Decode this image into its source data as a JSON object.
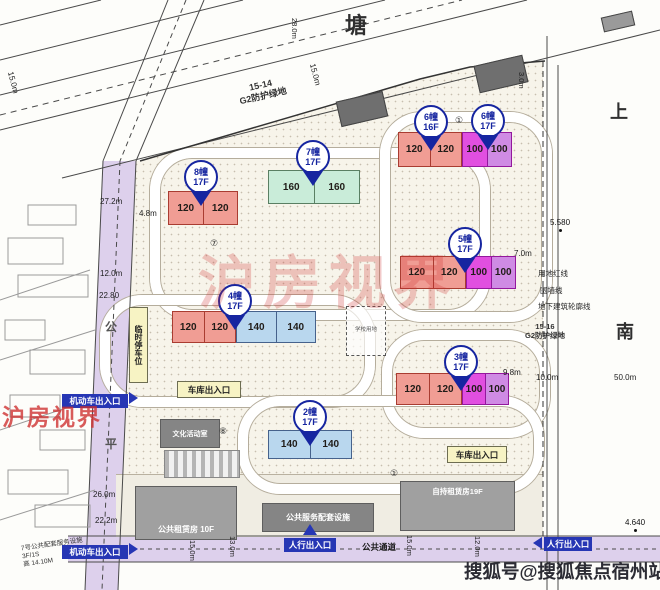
{
  "plan": {
    "roads": {
      "top_name": "塘",
      "right_name_chars": [
        "上",
        "南"
      ],
      "left_name_chars": [
        "公",
        "平"
      ],
      "public_passage": "公共通道"
    },
    "parcels": [
      {
        "code": "15-14",
        "label": "G2防护绿地"
      },
      {
        "code": "15-16",
        "label": "G2防护绿地"
      }
    ],
    "buildings": [
      {
        "id": "bldg-8",
        "balloon": "8幢",
        "floors": "17F",
        "parts": [
          {
            "color_key": "red",
            "units": [
              "120",
              "120"
            ]
          }
        ]
      },
      {
        "id": "bldg-7",
        "balloon": "7幢",
        "floors": "17F",
        "parts": [
          {
            "color_key": "green",
            "units": [
              "160",
              "160"
            ]
          }
        ]
      },
      {
        "id": "bldg-6a",
        "balloon": "6幢",
        "floors": "16F",
        "parts": [
          {
            "color_key": "red",
            "units": [
              "120",
              "120"
            ]
          }
        ]
      },
      {
        "id": "bldg-6b",
        "balloon": "6幢",
        "floors": "17F",
        "parts": [
          {
            "color_key": "magenta",
            "units": [
              "100",
              "100"
            ]
          }
        ]
      },
      {
        "id": "bldg-5",
        "balloon": "5幢",
        "floors": "17F",
        "parts": [
          {
            "color_key": "red",
            "units": [
              "120",
              "120"
            ]
          },
          {
            "color_key": "magenta",
            "units": [
              "100",
              "100"
            ]
          }
        ]
      },
      {
        "id": "bldg-4",
        "balloon": "4幢",
        "floors": "17F",
        "parts": [
          {
            "color_key": "red",
            "units": [
              "120",
              "120"
            ]
          },
          {
            "color_key": "blue",
            "units": [
              "140",
              "140"
            ]
          }
        ]
      },
      {
        "id": "bldg-3",
        "balloon": "3幢",
        "floors": "17F",
        "parts": [
          {
            "color_key": "red",
            "units": [
              "120",
              "120"
            ]
          },
          {
            "color_key": "magenta",
            "units": [
              "100",
              "100"
            ]
          }
        ]
      },
      {
        "id": "bldg-2",
        "balloon": "2幢",
        "floors": "17F",
        "parts": [
          {
            "color_key": "blue",
            "units": [
              "140",
              "140"
            ]
          }
        ]
      }
    ],
    "facilities": [
      {
        "label": "公共租赁房 10F"
      },
      {
        "label": "公共服务配套设施"
      },
      {
        "label": "自持租赁房19F"
      },
      {
        "label": "文化活动室"
      },
      {
        "label": "临时停车位"
      },
      {
        "label": "学校用地"
      }
    ],
    "entrances": {
      "garage": "车库出入口",
      "pedestrian": "人行出入口",
      "vehicle": "机动车出入口"
    },
    "boundary_labels": [
      "用地红线",
      "围墙线",
      "地下建筑轮廓线"
    ],
    "dimensions": [
      "27.2m",
      "4.8m",
      "12.0m",
      "22.80",
      "26.0m",
      "22.2m",
      "13.0m",
      "15.0m",
      "12.0m",
      "10.0m",
      "50.0m",
      "7.0m",
      "9.8m",
      "3.0m",
      "28.0m"
    ],
    "elevations": [
      "5.580",
      "4.640"
    ],
    "note": {
      "line1": "7号公共配套服务设施",
      "line2": "3F/1S",
      "line3": "高 14.10M"
    },
    "circled_numbers": [
      "①",
      "⑦",
      "⑧"
    ],
    "watermarks": {
      "center": "沪房视界",
      "left": "沪房视界",
      "bottom": "搜狐号@搜狐焦点宿州站"
    },
    "colors": {
      "red_building": "#f09d94",
      "green_building": "#c9ecd9",
      "magenta_building": "#e14fe0",
      "magenta_light": "#cf8be4",
      "blue_building": "#b9d7ee",
      "marker_blue": "#1625a0",
      "road_purple": "#ddd0ec",
      "entrance_blue": "#2636b4",
      "entrance_yellow": "#f7f3c4",
      "watermark_red": "#cd2d2d"
    }
  }
}
